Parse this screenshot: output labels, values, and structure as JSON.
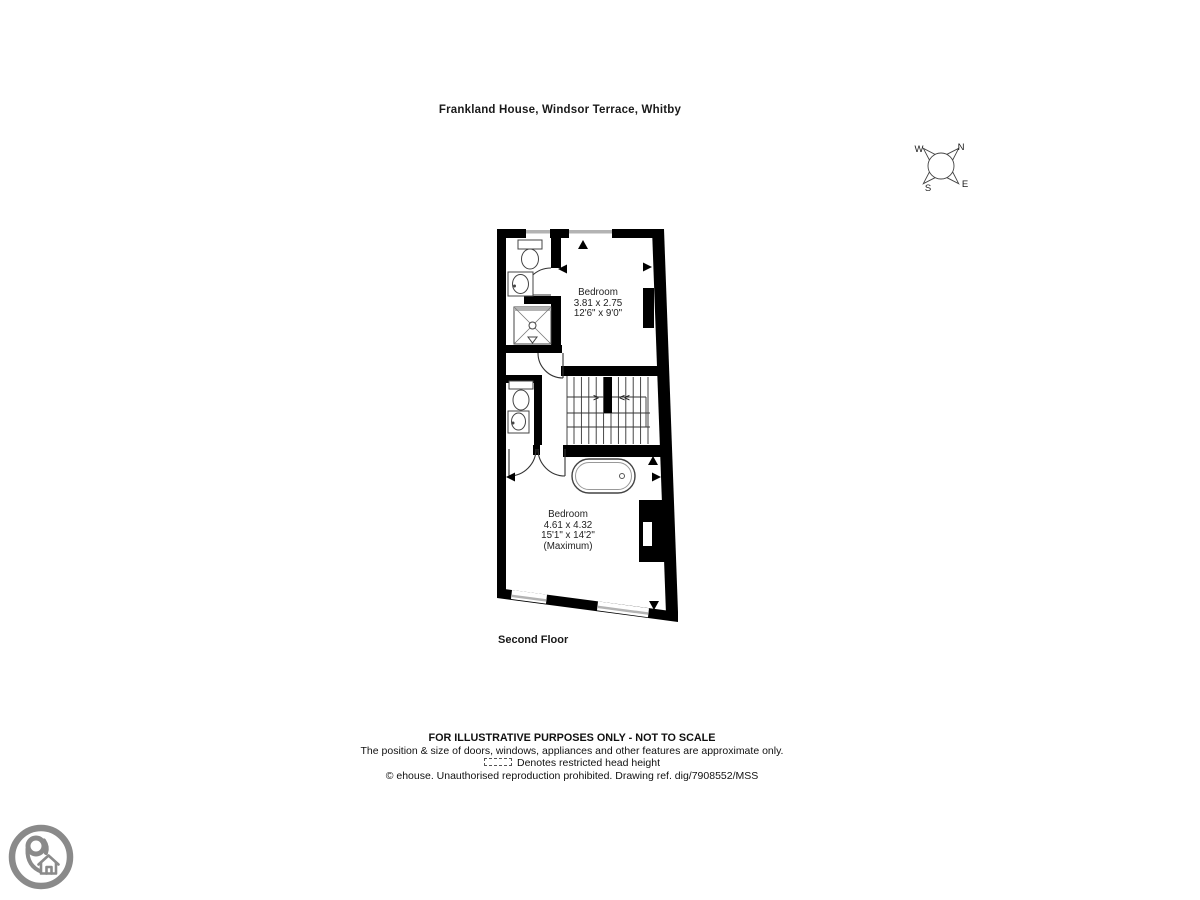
{
  "title": "Frankland House, Windsor Terrace, Whitby",
  "floor_label": "Second Floor",
  "compass": {
    "north": "N",
    "east": "E",
    "south": "S",
    "west": "W"
  },
  "rooms": {
    "bedroom1": {
      "name": "Bedroom",
      "metric": "3.81 x 2.75",
      "imperial": "12'6\" x 9'0\""
    },
    "bedroom2": {
      "name": "Bedroom",
      "metric": "4.61 x 4.32",
      "imperial": "15'1\" x 14'2\"",
      "note": "(Maximum)"
    }
  },
  "stairs": {
    "arrow_up": ">",
    "arrow_down": "<<"
  },
  "footer": {
    "line1": "FOR ILLUSTRATIVE PURPOSES ONLY - NOT TO SCALE",
    "line2": "The position & size of doors, windows, appliances and other features are approximate only.",
    "line3": "Denotes restricted head height",
    "line4": "© ehouse. Unauthorised reproduction prohibited. Drawing ref. dig/7908552/MSS"
  },
  "colors": {
    "wall": "#000000",
    "window_glass": "#b3b3b3",
    "fixture_line": "#444444",
    "logo_gray": "#8a8a8a"
  }
}
